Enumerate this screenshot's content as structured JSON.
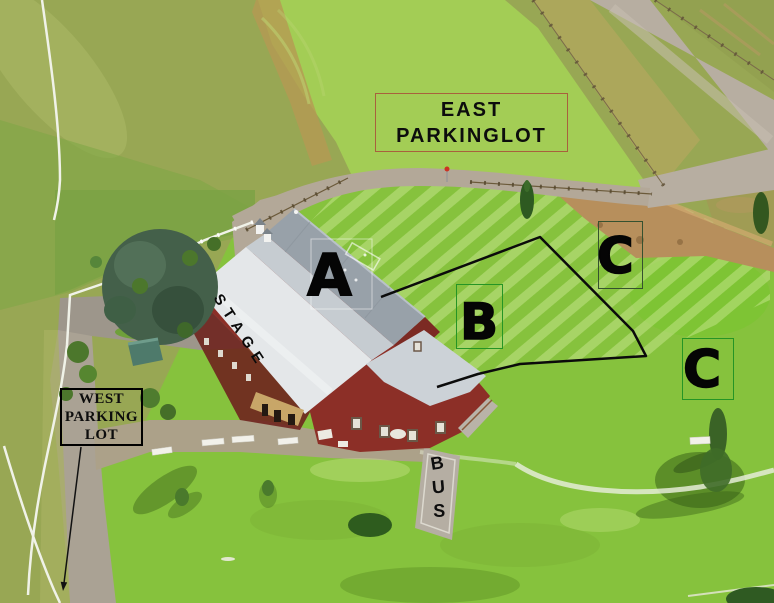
{
  "venue_map": {
    "type": "aerial-venue-map",
    "labels": {
      "east_lot": {
        "line1": "EAST",
        "line2": "PARKINGLOT"
      },
      "west_lot": {
        "line1": "WEST",
        "line2": "PARKING",
        "line3": "LOT"
      },
      "stage": "STAGE",
      "section_a": "A",
      "section_b": "B",
      "section_c_upper": "C",
      "section_c_lower": "C",
      "bus_letters": [
        "B",
        "U",
        "S"
      ]
    },
    "colors": {
      "highlight_green": "#86c23d",
      "east_field_green": "#a3cd55",
      "pasture_olive": "#98a754",
      "road_gravel": "#b7aea1",
      "dirt_tan": "#b78f5c",
      "barn_red": "#8c2f27",
      "barn_roof_gray": "#98a1a9",
      "stage_roof_white": "#e4e7e9",
      "section_outline": "#0b0b0b",
      "section_box_green": "#259525",
      "section_box_dark": "#35512f",
      "east_box_border": "#a8613d",
      "west_box_border": "#000000",
      "label_text": "#0d0d0d"
    }
  }
}
